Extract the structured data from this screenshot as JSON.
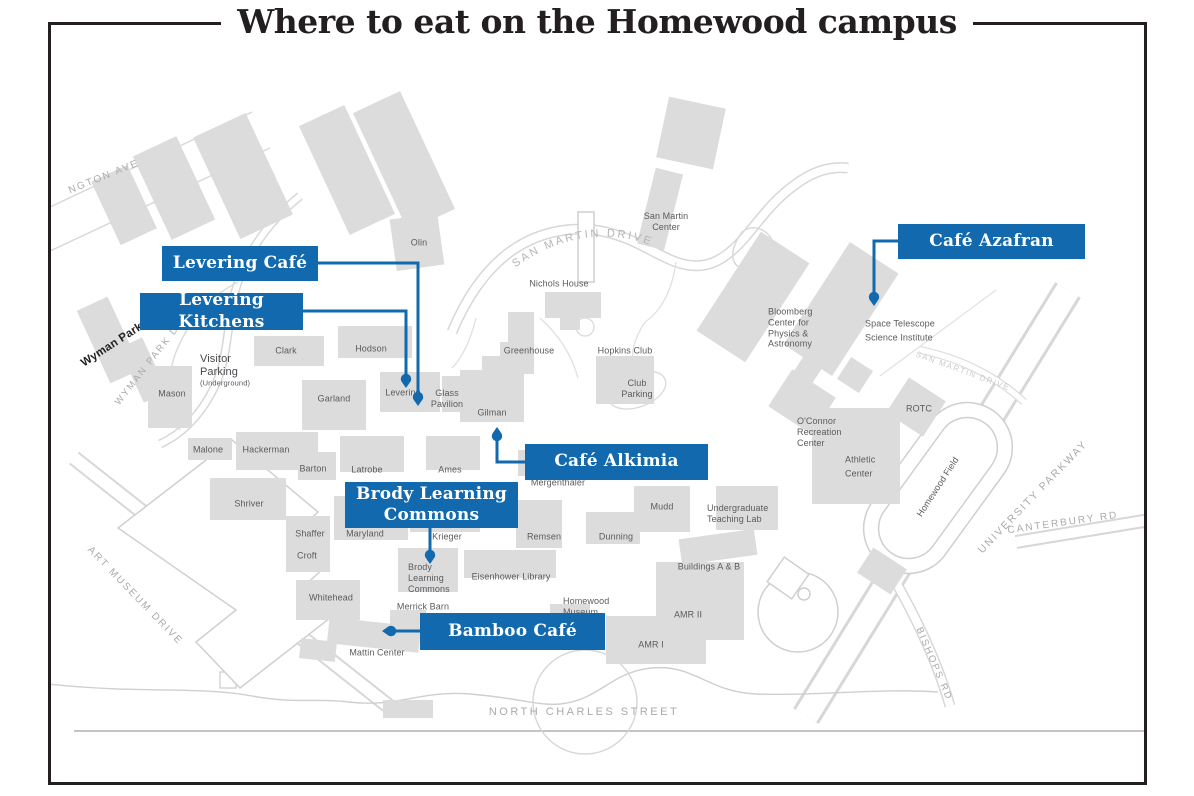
{
  "title": "Where to eat on the Homewood campus",
  "colors": {
    "accent_blue": "#1269ad",
    "building_fill": "#dcdcdc",
    "building_label": "#595b5e",
    "street_label": "#9d9fa2",
    "title_color": "#231f20"
  },
  "curved_street": "SAN MARTIN DRIVE",
  "callouts": [
    {
      "label": "Levering Café",
      "x": 162,
      "y": 246,
      "w": 156,
      "h": 35,
      "path": "M 318,263 L 418,263 L 418,399",
      "pin": {
        "x": 418,
        "y": 406,
        "dir": "down"
      }
    },
    {
      "label": "Levering Kitchens",
      "x": 140,
      "y": 293,
      "w": 163,
      "h": 37,
      "path": "M 303,311 L 406,311 L 406,381",
      "pin": {
        "x": 406,
        "y": 388,
        "dir": "down"
      }
    },
    {
      "label": "Café Azafran",
      "x": 898,
      "y": 224,
      "w": 187,
      "h": 35,
      "path": "M 898,241 L 874,241 L 874,299",
      "pin": {
        "x": 874,
        "y": 306,
        "dir": "down"
      }
    },
    {
      "label": "Café Alkimia",
      "x": 525,
      "y": 444,
      "w": 183,
      "h": 36,
      "path": "M 525,462 L 497,462 L 497,434",
      "pin": {
        "x": 497,
        "y": 427,
        "dir": "up"
      }
    },
    {
      "label": "Brody Learning\nCommons",
      "x": 345,
      "y": 482,
      "w": 173,
      "h": 46,
      "path": "M 430,528 L 430,557",
      "pin": {
        "x": 430,
        "y": 564,
        "dir": "down"
      }
    },
    {
      "label": "Bamboo Café",
      "x": 420,
      "y": 613,
      "w": 185,
      "h": 37,
      "path": "M 420,631 L 389,631",
      "pin": {
        "x": 382,
        "y": 631,
        "dir": "left"
      }
    }
  ],
  "map_labels": [
    {
      "text": "Olin",
      "x": 419,
      "y": 243
    },
    {
      "text": "San Martin\nCenter",
      "x": 666,
      "y": 222
    },
    {
      "text": "Nichols House",
      "x": 559,
      "y": 284
    },
    {
      "text": "Greenhouse",
      "x": 529,
      "y": 351
    },
    {
      "text": "Hopkins Club",
      "x": 625,
      "y": 351
    },
    {
      "text": "Club\nParking",
      "x": 637,
      "y": 389
    },
    {
      "text": "Clark",
      "x": 286,
      "y": 351
    },
    {
      "text": "Hodson",
      "x": 371,
      "y": 349
    },
    {
      "text": "Visitor\nParking",
      "x": 200,
      "y": 366,
      "align": "left",
      "size": 11,
      "color": "#47494c"
    },
    {
      "text": "(Underground)",
      "x": 200,
      "y": 383,
      "align": "left",
      "size": 7.5
    },
    {
      "text": "Mason",
      "x": 172,
      "y": 394
    },
    {
      "text": "Garland",
      "x": 334,
      "y": 399
    },
    {
      "text": "Levering",
      "x": 403,
      "y": 393
    },
    {
      "text": "Glass\nPavilion",
      "x": 447,
      "y": 399
    },
    {
      "text": "Gilman",
      "x": 492,
      "y": 413
    },
    {
      "text": "Malone",
      "x": 208,
      "y": 450
    },
    {
      "text": "Hackerman",
      "x": 266,
      "y": 450
    },
    {
      "text": "Barton",
      "x": 313,
      "y": 469
    },
    {
      "text": "Latrobe",
      "x": 367,
      "y": 470
    },
    {
      "text": "Ames",
      "x": 450,
      "y": 470
    },
    {
      "text": "Mergenthaler",
      "x": 558,
      "y": 483
    },
    {
      "text": "Shriver",
      "x": 249,
      "y": 504
    },
    {
      "text": "Mudd",
      "x": 662,
      "y": 507
    },
    {
      "text": "Undergraduate\nTeaching Lab",
      "x": 707,
      "y": 514,
      "align": "left"
    },
    {
      "text": "Shaffer",
      "x": 310,
      "y": 534
    },
    {
      "text": "Maryland",
      "x": 365,
      "y": 534
    },
    {
      "text": "Krieger",
      "x": 447,
      "y": 537
    },
    {
      "text": "Remsen",
      "x": 544,
      "y": 537
    },
    {
      "text": "Dunning",
      "x": 616,
      "y": 537
    },
    {
      "text": "Croft",
      "x": 307,
      "y": 556
    },
    {
      "text": "Brody\nLearning\nCommons",
      "x": 408,
      "y": 578,
      "align": "left"
    },
    {
      "text": "Eisenhower Library",
      "x": 511,
      "y": 577
    },
    {
      "text": "Whitehead",
      "x": 331,
      "y": 598
    },
    {
      "text": "Merrick Barn",
      "x": 423,
      "y": 607
    },
    {
      "text": "Homewood\nMuseum",
      "x": 563,
      "y": 607,
      "align": "left"
    },
    {
      "text": "Buildings A & B",
      "x": 709,
      "y": 567
    },
    {
      "text": "AMR II",
      "x": 688,
      "y": 615
    },
    {
      "text": "AMR I",
      "x": 651,
      "y": 645
    },
    {
      "text": "Mattin Center",
      "x": 377,
      "y": 653
    },
    {
      "text": "Bloomberg\nCenter for\nPhysics &\nAstronomy",
      "x": 768,
      "y": 328,
      "align": "left"
    },
    {
      "text": "Space Telescope\nScience Institute",
      "x": 865,
      "y": 331,
      "align": "left",
      "lh": 1.5
    },
    {
      "text": "O'Connor\nRecreation\nCenter",
      "x": 797,
      "y": 432,
      "align": "left"
    },
    {
      "text": "Athletic\nCenter",
      "x": 845,
      "y": 467,
      "align": "left",
      "lh": 1.6
    },
    {
      "text": "ROTC",
      "x": 919,
      "y": 409
    },
    {
      "text": "Homewood Field",
      "x": 938,
      "y": 487,
      "rot": -57
    }
  ],
  "street_labels": [
    {
      "text": "NGTON AVE",
      "x": 104,
      "y": 177,
      "rot": -22
    },
    {
      "text": "WYMAN PARK DR",
      "x": 150,
      "y": 362,
      "rot": -52,
      "size": 9.5
    },
    {
      "text": "Wyman Park",
      "x": 112,
      "y": 345,
      "rot": -33,
      "size": 11.5,
      "ls": 0.2,
      "color": "#231f20",
      "bold": true
    },
    {
      "text": "ART MUSEUM DRIVE",
      "x": 135,
      "y": 596,
      "rot": 46
    },
    {
      "text": "SAN MARTIN DRIVE",
      "x": 963,
      "y": 371,
      "rot": 20,
      "size": 8,
      "ls": 1.5,
      "color": "#c9cbcd"
    },
    {
      "text": "UNIVERSITY PARKWAY",
      "x": 1033,
      "y": 497,
      "rot": -46,
      "size": 10.5
    },
    {
      "text": "CANTERBURY RD",
      "x": 1063,
      "y": 523,
      "rot": -8
    },
    {
      "text": "BISHOPS RD",
      "x": 934,
      "y": 664,
      "rot": 67,
      "size": 9.5
    },
    {
      "text": "NORTH CHARLES STREET",
      "x": 584,
      "y": 712,
      "rot": 0,
      "size": 11,
      "ls": 2.5
    }
  ]
}
